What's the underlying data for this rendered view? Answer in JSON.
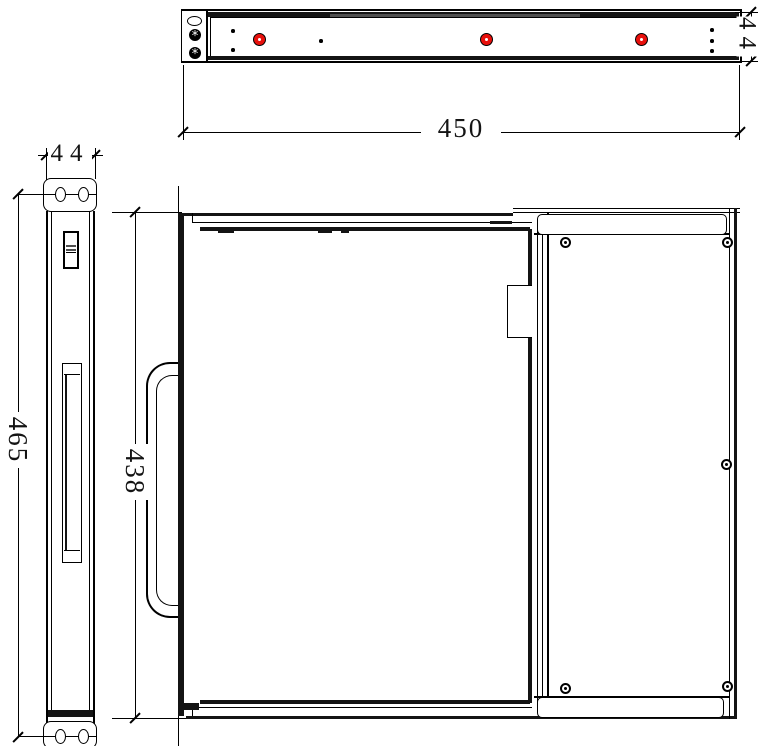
{
  "dimensions": {
    "front_width": "450",
    "front_height": "44",
    "side_width": "44",
    "side_height": "465",
    "plan_depth": "438"
  },
  "colors": {
    "line": "#000000",
    "led_red": "#e8100c",
    "band_dark": "#141414",
    "band_gray": "#4f4f4f",
    "background": "#ffffff"
  },
  "icons": {
    "led": "red-led-indicator",
    "front_ear_screw": "star-head-screw",
    "panel_screw": "screw-with-center-dot",
    "front_ear_slot": "oval-mounting-slot",
    "ear_hole": "round-mounting-hole"
  }
}
